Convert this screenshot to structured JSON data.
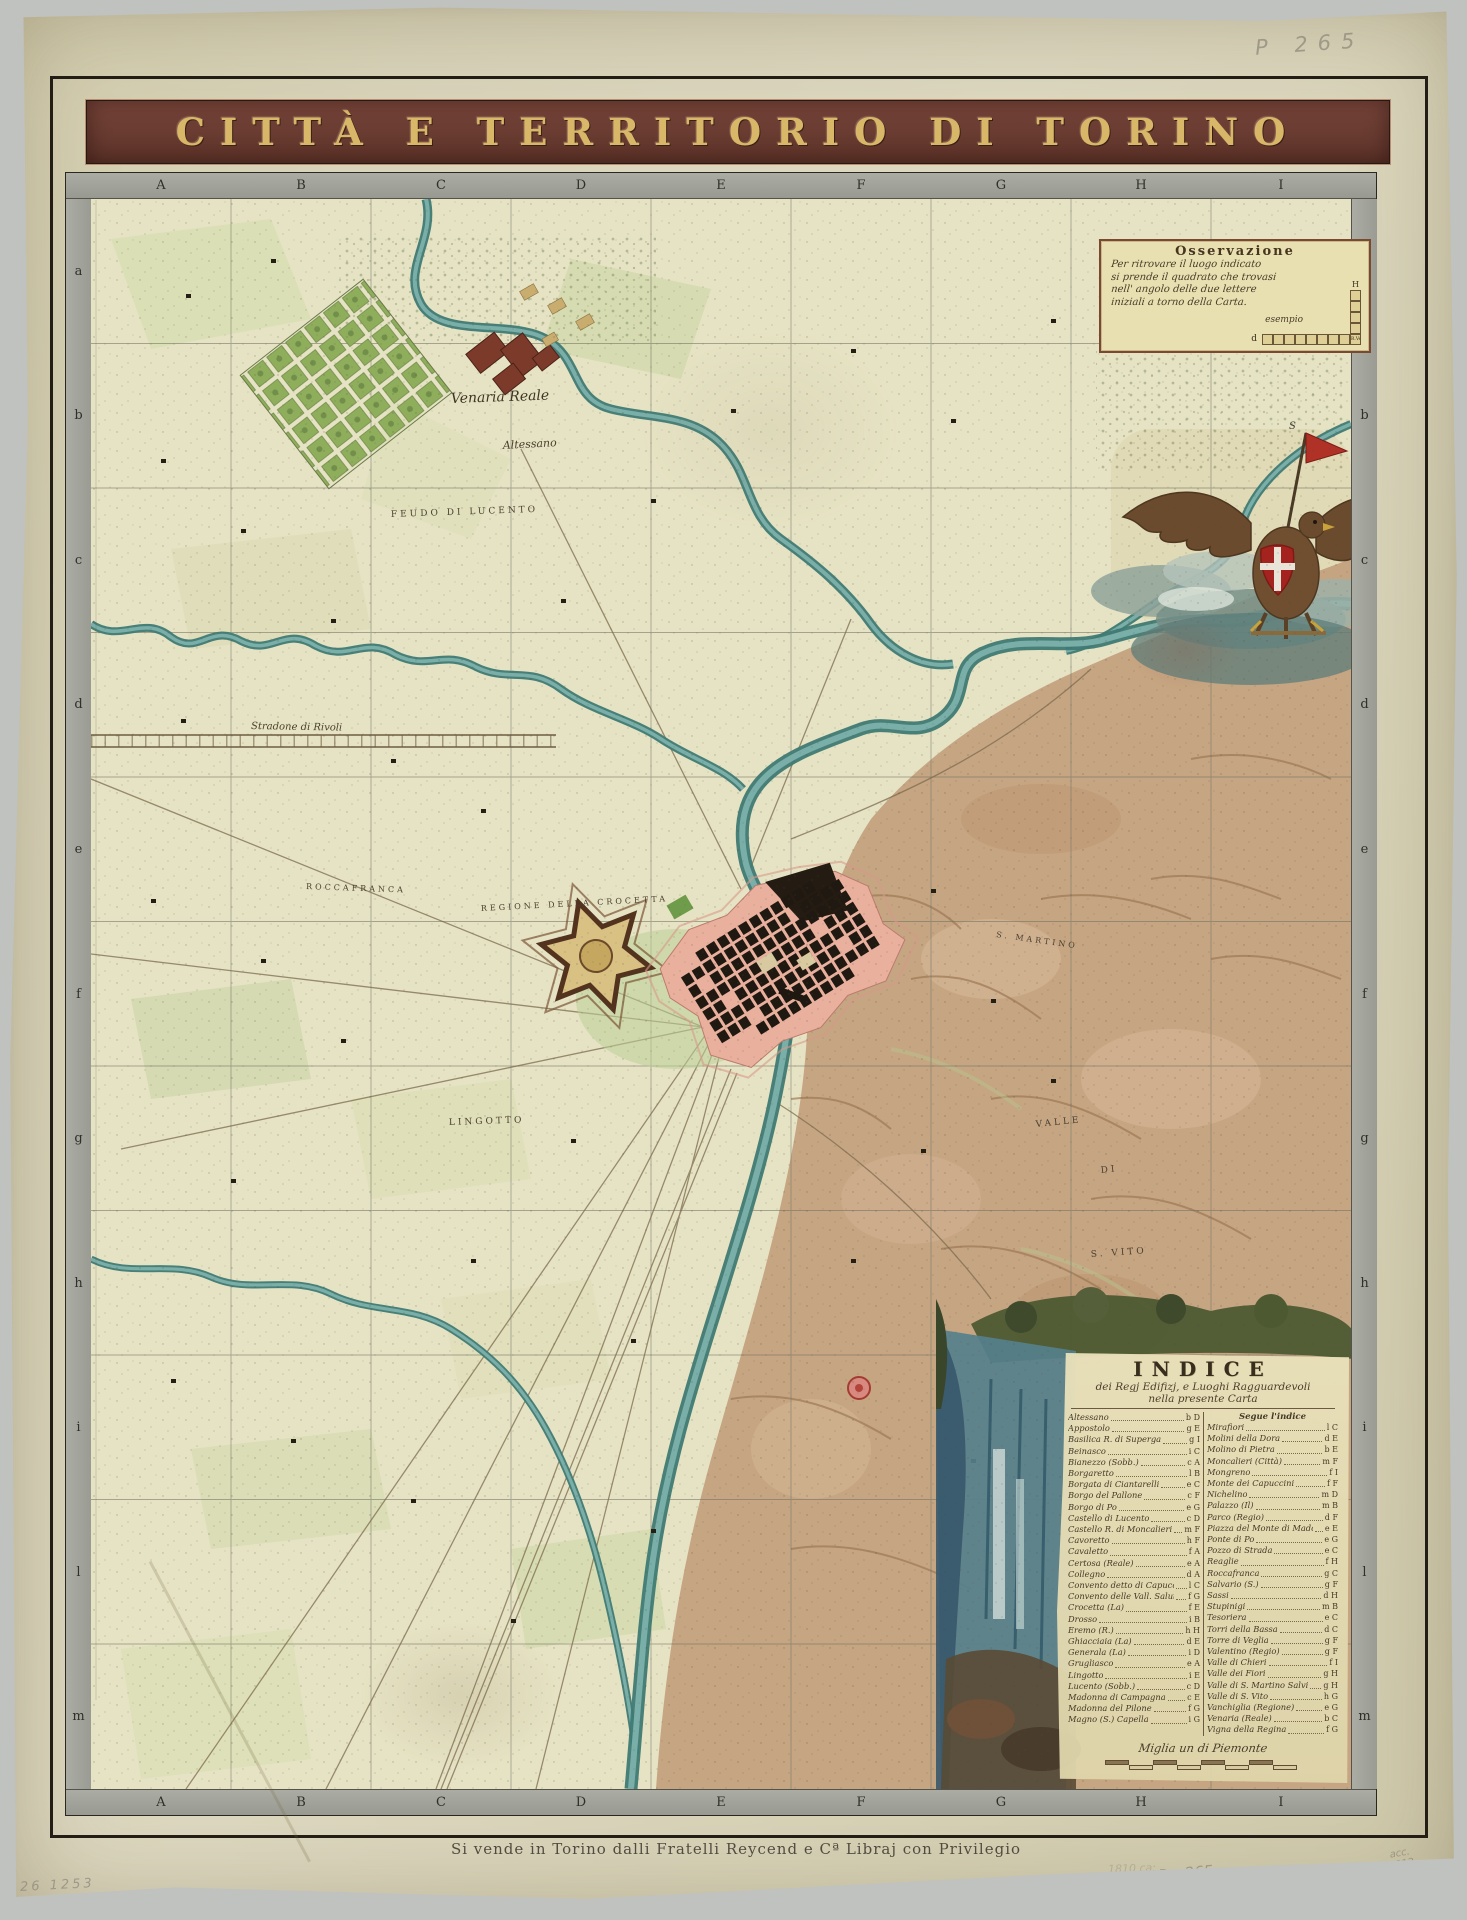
{
  "title_banner": {
    "text": "CITTÀ E TERRITORIO DI TORINO",
    "bg": "#6e3f34",
    "fg": "#d9b768"
  },
  "grid": {
    "top_letters": [
      "A",
      "B",
      "C",
      "D",
      "E",
      "F",
      "G",
      "H",
      "I"
    ],
    "bottom_letters": [
      "A",
      "B",
      "C",
      "D",
      "E",
      "F",
      "G",
      "H",
      "I"
    ],
    "left_letters": [
      "a",
      "b",
      "c",
      "d",
      "e",
      "f",
      "g",
      "h",
      "i",
      "l",
      "m"
    ],
    "right_letters": [
      "a",
      "b",
      "c",
      "d",
      "e",
      "f",
      "g",
      "h",
      "i",
      "l",
      "m"
    ]
  },
  "observation": {
    "title": "Osservazione",
    "lines": [
      "Per ritrovare il luogo indicato",
      "si prende il quadrato che trovasi",
      "nell' angolo delle due lettere",
      "iniziali a torno della Carta."
    ],
    "example_label": "esempio",
    "example_row_letter": "d",
    "example_col_letter": "H",
    "example_corner": "R.Ven"
  },
  "emblem": {
    "name": "savoy-eagle-with-shield",
    "shield_color": "#a5231f",
    "pennant_letter": "S"
  },
  "map_labels": [
    {
      "text": "Venaria Reale",
      "x": 360,
      "y": 204,
      "cls": "script",
      "rot": -2,
      "size": 14
    },
    {
      "text": "Altessano",
      "x": 412,
      "y": 250,
      "cls": "scriptsm",
      "rot": -3,
      "size": 11
    },
    {
      "text": "FEUDO DI LUCENTO",
      "x": 300,
      "y": 318,
      "cls": "caps",
      "rot": -2,
      "size": 9
    },
    {
      "text": "Stradone di Rivoli",
      "x": 160,
      "y": 530,
      "cls": "scriptsm",
      "rot": 1,
      "size": 10
    },
    {
      "text": "ROCCAFRANCA",
      "x": 215,
      "y": 690,
      "cls": "caps",
      "rot": 2,
      "size": 8
    },
    {
      "text": "REGIONE DELLA CROCETTA",
      "x": 390,
      "y": 712,
      "cls": "caps",
      "rot": -3,
      "size": 8
    },
    {
      "text": "LINGOTTO",
      "x": 358,
      "y": 926,
      "cls": "caps",
      "rot": -2,
      "size": 9
    },
    {
      "text": "S. MARTINO",
      "x": 905,
      "y": 738,
      "cls": "caps",
      "rot": 8,
      "size": 8
    },
    {
      "text": "VALLE",
      "x": 945,
      "y": 928,
      "cls": "caps",
      "rot": -6,
      "size": 9
    },
    {
      "text": "DI",
      "x": 1010,
      "y": 974,
      "cls": "caps",
      "rot": -6,
      "size": 9
    },
    {
      "text": "S. VITO",
      "x": 1000,
      "y": 1058,
      "cls": "caps",
      "rot": -4,
      "size": 9
    }
  ],
  "indice": {
    "title": "INDICE",
    "subtitle1": "dei Regj Edifizj, e Luoghi Ragguardevoli",
    "subtitle2": "nella presente Carta",
    "right_header": "Segue l'indice",
    "left": [
      {
        "n": "Altessano",
        "r": "b D"
      },
      {
        "n": "Appostolo",
        "r": "g E"
      },
      {
        "n": "Basilica R. di Superga",
        "r": "g I"
      },
      {
        "n": "Beinasco",
        "r": "i C"
      },
      {
        "n": "Bianezzo (Sobb.)",
        "r": "c A"
      },
      {
        "n": "Borgaretto",
        "r": "l B"
      },
      {
        "n": "Borgata di Ciantarelli",
        "r": "e C"
      },
      {
        "n": "Borgo del Pallone",
        "r": "c F"
      },
      {
        "n": "Borgo di Po",
        "r": "e G"
      },
      {
        "n": "Castello di Lucento",
        "r": "c D"
      },
      {
        "n": "Castello R. di Moncalieri",
        "r": "m F"
      },
      {
        "n": "Cavoretto",
        "r": "h F"
      },
      {
        "n": "Cavaletto",
        "r": "f A"
      },
      {
        "n": "Certosa (Reale)",
        "r": "e A"
      },
      {
        "n": "Collegno",
        "r": "d A"
      },
      {
        "n": "Convento detto di Capuccini",
        "r": "l C"
      },
      {
        "n": "Convento delle Vall. Salut.",
        "r": "f G"
      },
      {
        "n": "Crocetta (La)",
        "r": "f E"
      },
      {
        "n": "Drosso",
        "r": "i B"
      },
      {
        "n": "Eremo (R.)",
        "r": "h H"
      },
      {
        "n": "Ghiacciaia (La)",
        "r": "d E"
      },
      {
        "n": "Generala (La)",
        "r": "i D"
      },
      {
        "n": "Grugliasco",
        "r": "e A"
      },
      {
        "n": "Lingotto",
        "r": "i E"
      },
      {
        "n": "Lucento (Sobb.)",
        "r": "c D"
      },
      {
        "n": "Madonna di Campagna",
        "r": "c E"
      },
      {
        "n": "Madonna del Pilone",
        "r": "f G"
      },
      {
        "n": "Magno (S.) Capella",
        "r": "i G"
      }
    ],
    "right": [
      {
        "n": "Mirafiori",
        "r": "l C"
      },
      {
        "n": "Molini della Dora",
        "r": "d E"
      },
      {
        "n": "Molino di Pietra",
        "r": "b E"
      },
      {
        "n": "Moncalieri (Città)",
        "r": "m F"
      },
      {
        "n": "Mongreno",
        "r": "f I"
      },
      {
        "n": "Monte dei Capuccini",
        "r": "f F"
      },
      {
        "n": "Nichelino",
        "r": "m D"
      },
      {
        "n": "Palazzo (Il)",
        "r": "m B"
      },
      {
        "n": "Parco (Regio)",
        "r": "d F"
      },
      {
        "n": "Piazza del Monte di Madonna",
        "r": "e E"
      },
      {
        "n": "Ponte di Po",
        "r": "e G"
      },
      {
        "n": "Pozzo di Strada",
        "r": "e C"
      },
      {
        "n": "Reaglie",
        "r": "f H"
      },
      {
        "n": "Roccafranca",
        "r": "g C"
      },
      {
        "n": "Salvario (S.)",
        "r": "g F"
      },
      {
        "n": "Sassi",
        "r": "d H"
      },
      {
        "n": "Stupinigi",
        "r": "m B"
      },
      {
        "n": "Tesoriera",
        "r": "e C"
      },
      {
        "n": "Torri della Bassa",
        "r": "d C"
      },
      {
        "n": "Torre di Veglia",
        "r": "g F"
      },
      {
        "n": "Valentino (Regio)",
        "r": "g F"
      },
      {
        "n": "Valle di Chieri",
        "r": "f I"
      },
      {
        "n": "Valle dei Fiori",
        "r": "g H"
      },
      {
        "n": "Valle di S. Martino Salvi",
        "r": "g H"
      },
      {
        "n": "Valle di S. Vito",
        "r": "h G"
      },
      {
        "n": "Vanchiglia (Regione)",
        "r": "e G"
      },
      {
        "n": "Venaria (Reale)",
        "r": "b C"
      },
      {
        "n": "Vigna della Regina",
        "r": "f G"
      }
    ],
    "scale_label": "Miglia un di Piemonte",
    "scale_segments": 8
  },
  "imprint": "Si vende in Torino dalli Fratelli Reycend e Cª Libraj con Privilegio",
  "annotations": {
    "top_right": "P 265",
    "bottom_left": "26  1253",
    "faint_date": "1810 ca:",
    "engraver": "Stagnon inc.",
    "plate": "P. - 265",
    "acc_line1": "acc.",
    "acc_line2": "1912"
  },
  "colors": {
    "banner_bg": "#6e3f34",
    "banner_text": "#d9b768",
    "paper": "#d9d4ba",
    "map_base": "#e6e3c4",
    "river": "#3f7a74",
    "hills": "#c29d7b",
    "city_black": "#201911",
    "city_pink": "#e9b09e",
    "citadel": "#d9c184",
    "shield_red": "#a5231f",
    "strip_gray": "#a3a59d",
    "border_red": "#b0625a"
  }
}
